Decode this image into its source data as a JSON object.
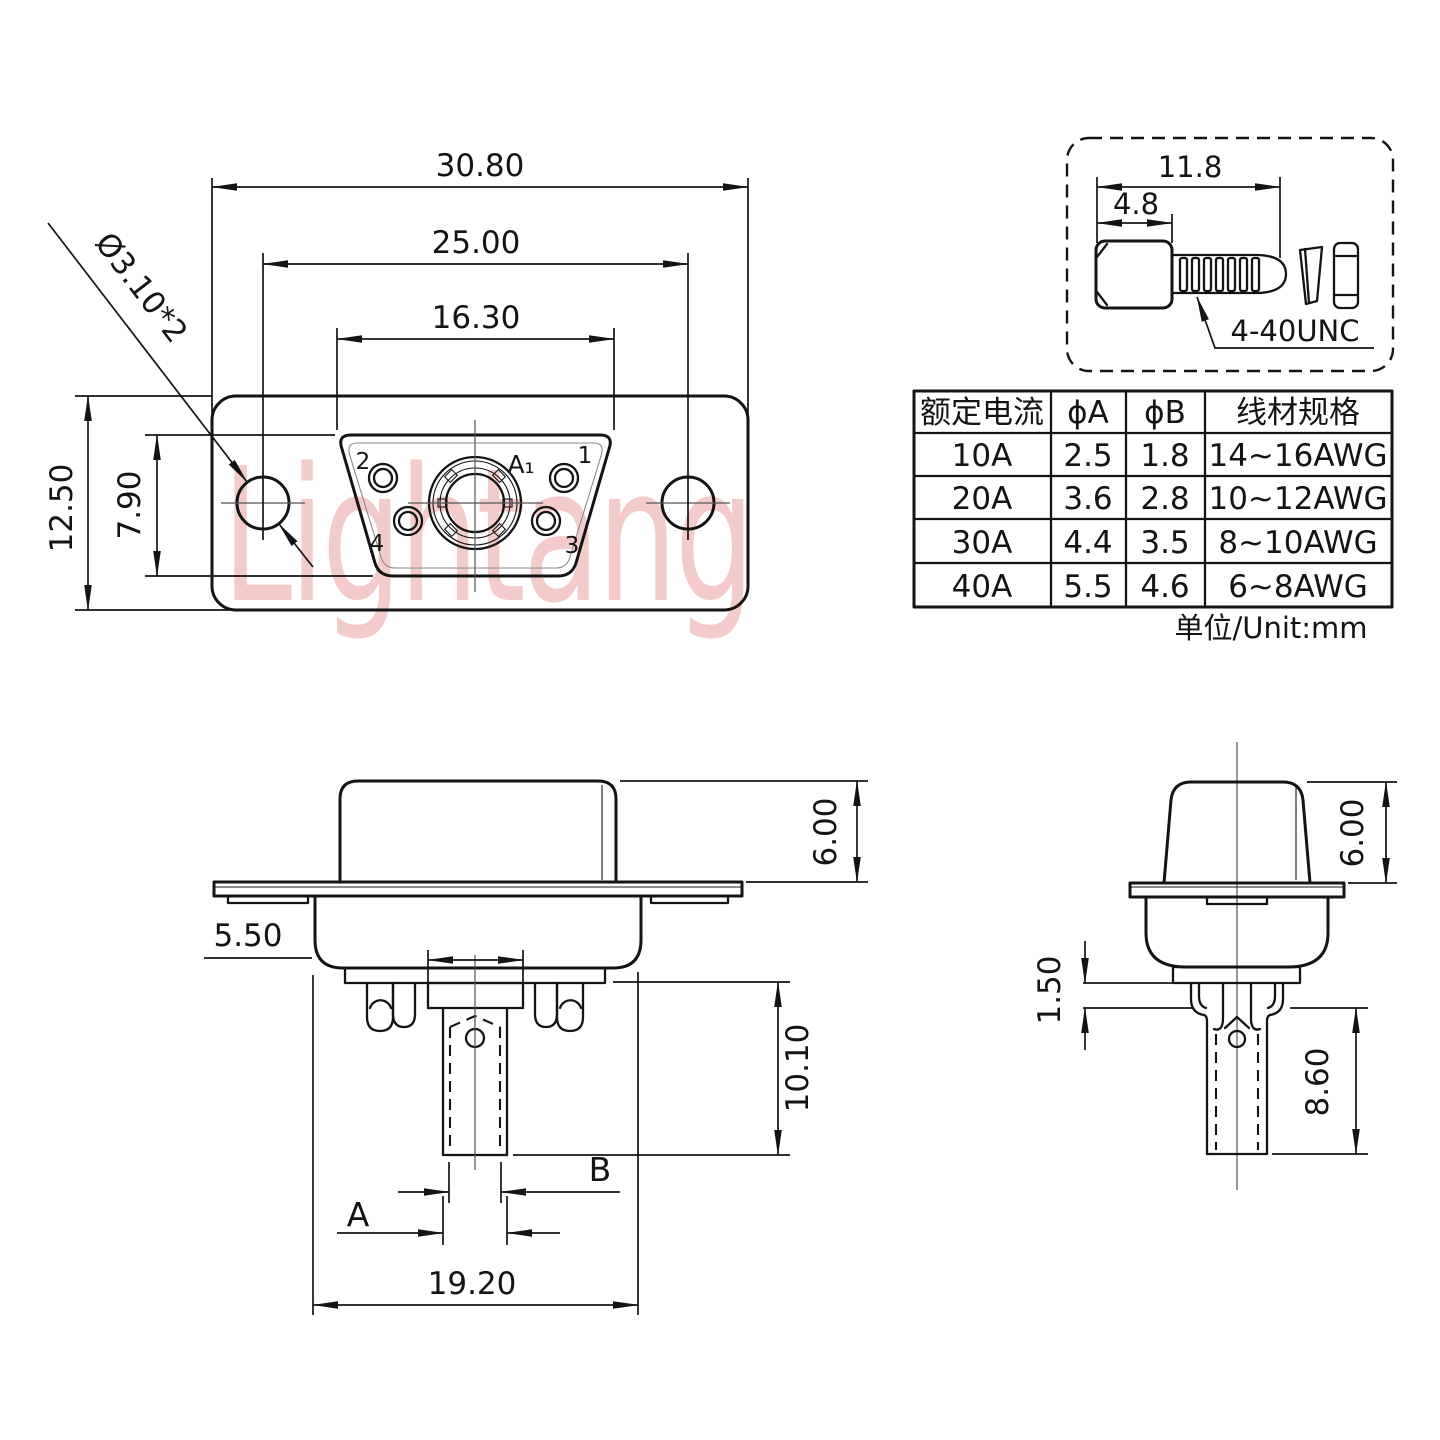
{
  "watermark": {
    "text": "Lightang",
    "color": "#dd5555"
  },
  "front_view": {
    "dim_overall_width": "30.80",
    "dim_hole_spacing": "25.00",
    "dim_insert_width": "16.30",
    "dim_overall_height": "12.50",
    "dim_insert_height": "7.90",
    "dim_mounting_holes": "Ø3.10*2",
    "pin1": "1",
    "pin2": "2",
    "pin3": "3",
    "pin4": "4",
    "pin_center": "A₁"
  },
  "screw_detail": {
    "dim_total_length": "11.8",
    "dim_head_length": "4.8",
    "thread_spec": "4-40UNC"
  },
  "spec_table": {
    "headers": [
      "额定电流",
      "ϕA",
      "ϕB",
      "线材规格"
    ],
    "rows": [
      [
        "10A",
        "2.5",
        "1.8",
        "14~16AWG"
      ],
      [
        "20A",
        "3.6",
        "2.8",
        "10~12AWG"
      ],
      [
        "30A",
        "4.4",
        "3.5",
        "8~10AWG"
      ],
      [
        "40A",
        "5.5",
        "4.6",
        "6~8AWG"
      ]
    ],
    "unit_note": "单位/Unit:mm"
  },
  "side_view": {
    "dim_shell_height": "6.00",
    "dim_cup_width": "5.50",
    "dim_tail_length": "10.10",
    "dim_body_width": "19.20",
    "label_a": "A",
    "label_b": "B"
  },
  "end_view": {
    "dim_shell_height": "6.00",
    "dim_step_height": "1.50",
    "dim_tail_length": "8.60"
  }
}
